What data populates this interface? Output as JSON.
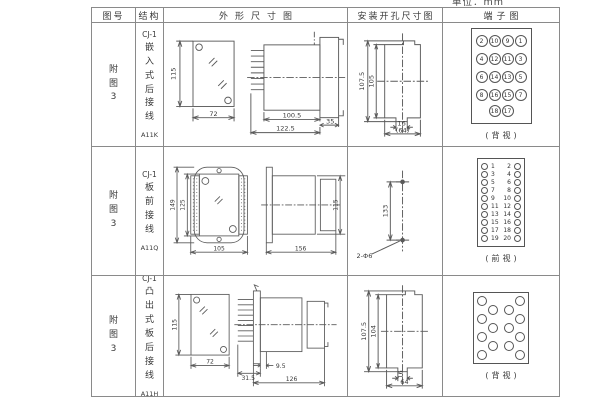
{
  "page": {
    "unit_label": "单位：mm"
  },
  "headers": {
    "fig_no": "图号",
    "structure": "结构",
    "outline": "外形尺寸图",
    "install": "安装开孔尺寸图",
    "terminal": "端子图"
  },
  "rows": [
    {
      "fig_no": "附图3",
      "structure": {
        "model": "CJ-1",
        "type": "嵌入式后接线",
        "code": "A11K"
      },
      "outline": {
        "front_height": "115",
        "front_width": "72",
        "body_depth": "100.5",
        "total_depth": "122.5",
        "flange_depth": "35"
      },
      "install": {
        "outer_height": "107.5",
        "inner_height": "105",
        "notch_width": "16",
        "cutout_width": "(64)"
      },
      "terminal": {
        "view_label": "(背视)",
        "grid": [
          [
            "2",
            "10",
            "9",
            "1"
          ],
          [
            "4",
            "12",
            "11",
            "3"
          ],
          [
            "6",
            "14",
            "13",
            "5"
          ],
          [
            "8",
            "16",
            "15",
            "7"
          ]
        ],
        "bottom_pair": [
          "18",
          "17"
        ]
      }
    },
    {
      "fig_no": "附图3",
      "structure": {
        "model": "CJ-1",
        "type": "板前接线",
        "code": "A11Q"
      },
      "outline": {
        "plate_height": "149",
        "body_height": "125",
        "front_width": "105",
        "body_depth": "156",
        "side_height": "115"
      },
      "install": {
        "hole_spacing": "133",
        "hole_label": "2-Φ6"
      },
      "terminal": {
        "view_label": "(前视)",
        "left_numbers": [
          "1",
          "3",
          "5",
          "7",
          "9",
          "11",
          "13",
          "15",
          "17",
          "19"
        ],
        "right_numbers": [
          "2",
          "4",
          "6",
          "8",
          "10",
          "12",
          "14",
          "16",
          "18",
          "20"
        ]
      }
    },
    {
      "fig_no": "附图3",
      "structure": {
        "model": "CJ-1",
        "type": "凸出式板后接线",
        "code": "A11H"
      },
      "outline": {
        "front_height": "115",
        "front_width": "72",
        "pins_depth": "31.5",
        "step_depth": "9.5",
        "total_depth": "126"
      },
      "install": {
        "outer_height": "107.5",
        "inner_height": "104",
        "notch_width": "16",
        "cutout_width": "64"
      },
      "terminal": {
        "view_label": "(背视)",
        "side_circle_count": 7
      }
    }
  ]
}
